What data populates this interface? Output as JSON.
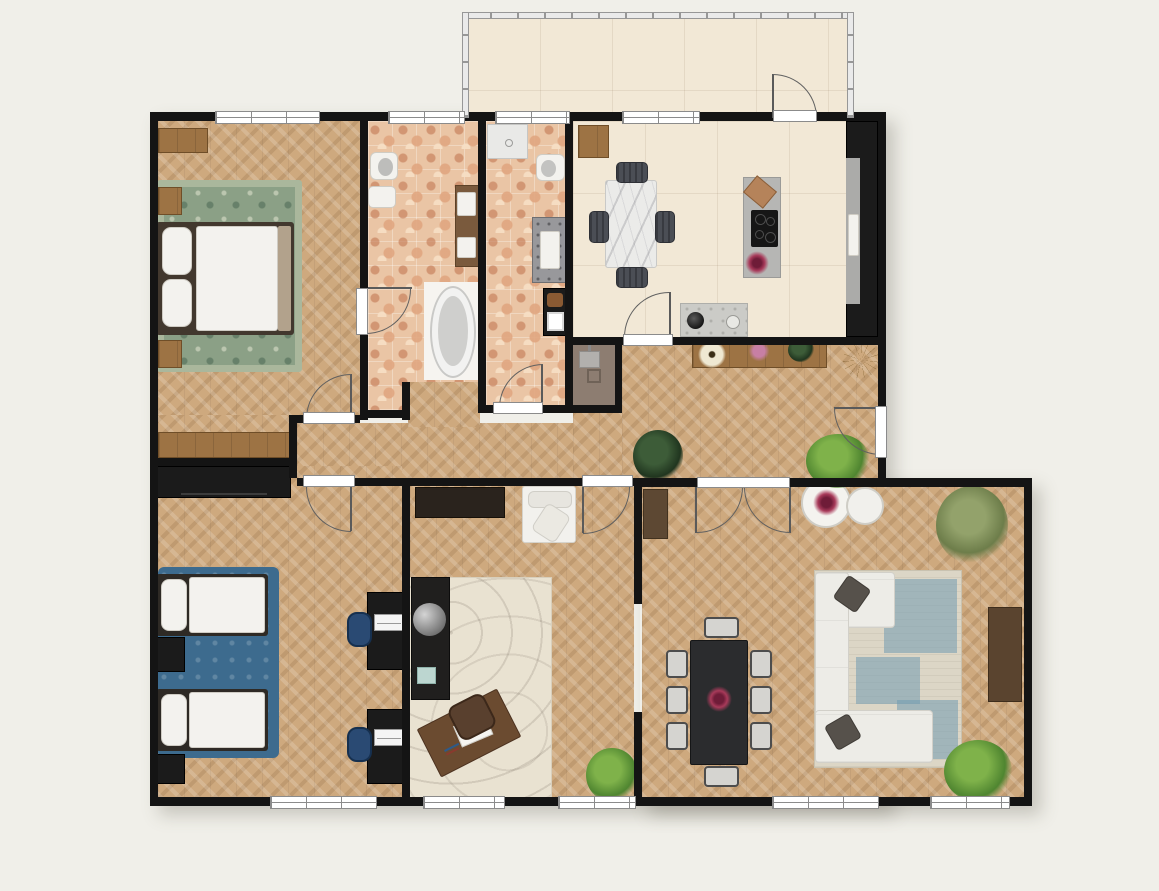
{
  "title": "Apartment floor plan (top-down render)",
  "canvas": {
    "width": 1159,
    "height": 891,
    "background": "#f0efe9",
    "wall_color": "#141414"
  },
  "rooms": {
    "balcony": {
      "label": "Balcony",
      "floor": "beige tile",
      "features": [
        "perimeter railing",
        "door to kitchen"
      ]
    },
    "master_bedroom": {
      "label": "Master Bedroom",
      "floor": "herringbone parquet",
      "furniture": [
        "double bed with white duvet",
        "green vintage rug",
        "wooden nightstand (top)",
        "wooden nightstand (bottom)",
        "wooden dresser",
        "wooden sideboard"
      ]
    },
    "bathroom": {
      "label": "Bathroom",
      "floor": "terracotta terrazzo tile",
      "furniture": [
        "toilet",
        "hand basin",
        "wooden double vanity",
        "freestanding bathtub"
      ]
    },
    "shower_room": {
      "label": "Shower Room",
      "floor": "terracotta terrazzo tile",
      "furniture": [
        "shower tray",
        "toilet",
        "stone vanity with sink",
        "black towel cabinet"
      ]
    },
    "kitchen": {
      "label": "Kitchen / Dining",
      "floor": "cream tile",
      "furniture": [
        "marble dining table",
        "4 upholstered chairs",
        "island with induction cooktop",
        "cutting board",
        "flower bowl",
        "tall dark cabinet run with sink",
        "counter with faucet",
        "wooden cabinet"
      ]
    },
    "hallway": {
      "label": "Hallway",
      "floor": "herringbone parquet",
      "furniture": [
        "wooden console with flowers",
        "dark potted plant",
        "bright potted plant",
        "dried-branch decoration"
      ]
    },
    "storage_nook": {
      "label": "Storage Nook",
      "floor": "taupe",
      "furniture": [
        "chair",
        "wall lamp",
        "floor frame"
      ]
    },
    "twin_bedroom": {
      "label": "Twin Bedroom",
      "floor": "herringbone parquet",
      "furniture": [
        "single bed A",
        "single bed B",
        "blue rug",
        "black wardrobe",
        "2 black nightstands",
        "2 black desks with laptops",
        "2 blue desk chairs"
      ]
    },
    "office": {
      "label": "Office",
      "floor": "herringbone parquet",
      "furniture": [
        "dark wall shelf",
        "white armchair",
        "black cabinet",
        "globe",
        "teal tray",
        "berber cream rug",
        "angled wooden writing desk",
        "brown leather chair",
        "potted plant"
      ]
    },
    "living_room": {
      "label": "Living Room",
      "floor": "herringbone parquet",
      "furniture": [
        "white corner sofa",
        "2 dark throw pillows",
        "blue-cream area rug",
        "black 8-seat dining table",
        "flower centerpiece",
        "6 side chairs + 2 end chairs",
        "2 round white side tables",
        "media console",
        "corner cabinet",
        "olive plant",
        "bright plant"
      ]
    }
  },
  "openings": {
    "window_count": 9,
    "windows": [
      "master bedroom (top)",
      "bathroom (top)",
      "shower room (top)",
      "kitchen (top)",
      "twin bedroom (bottom)",
      "office (bottom, left)",
      "office (bottom, right)",
      "living room (bottom, left)",
      "living room (bottom, right)"
    ],
    "doors": [
      "balcony door",
      "bedroom-to-bathroom door",
      "master bedroom door",
      "twin bedroom door",
      "shower room door",
      "kitchen door",
      "office door",
      "living room double door",
      "apartment entry door"
    ]
  },
  "colors": {
    "parquet": "#cea97e",
    "cream_tile": "#f2e8d6",
    "terrazzo_tile": "#eac5a5",
    "green_rug": "#8ba086",
    "blue_rug": "#3d6b8e",
    "living_rug_blue": "#719bb0",
    "sofa_white": "#edece7",
    "black_furniture": "#1b1b1b",
    "wood_furniture": "#9d7344",
    "island_gray": "#b6b6b4",
    "flower_accent": "#a83a5a",
    "door_arc": "#606060"
  }
}
